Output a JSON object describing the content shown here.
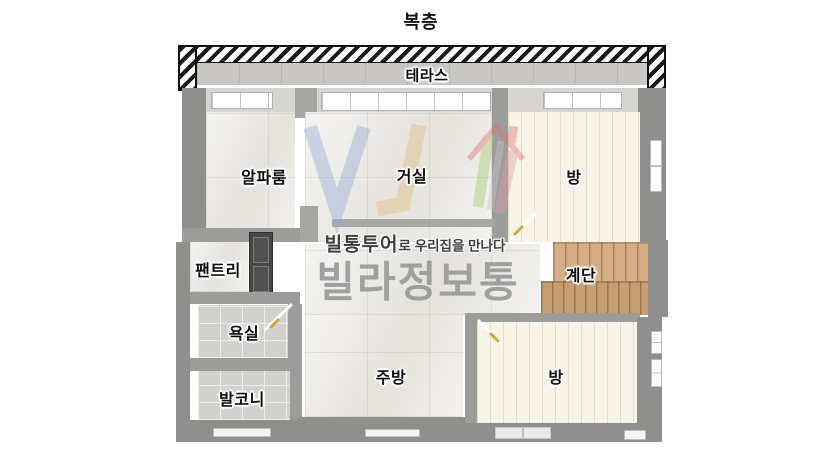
{
  "title": "복층",
  "rooms": {
    "terrace": {
      "label": "테라스"
    },
    "alpha": {
      "label": "알파룸"
    },
    "living": {
      "label": "거실"
    },
    "bedroom_top": {
      "label": "방"
    },
    "pantry": {
      "label": "팬트리"
    },
    "stairs": {
      "label": "계단"
    },
    "bath": {
      "label": "욕실"
    },
    "kitchen": {
      "label": "주방"
    },
    "balcony": {
      "label": "발코니"
    },
    "bedroom_bottom": {
      "label": "방"
    }
  },
  "watermark": {
    "brand_bold": "빌통투어",
    "tagline_rest": "로 우리집을 만나다",
    "brand_large": "빌라정보통"
  },
  "colors": {
    "wall_gray": "#9c9c9a",
    "marble_floor": "#eae8e3",
    "plank_floor": "#f8f3e7",
    "tile_floor": "#d2d1ce",
    "terrace_floor": "#c8c7c3",
    "stair_wood_upper": "#d4ae84",
    "stair_wood_lower": "#c59e73",
    "hatch_black": "#1a1a1a",
    "watermark_gray": "#9a9a9a",
    "tagline_dark": "#3e3e3e",
    "door_handle_gold": "#d8a62a",
    "logo_blue": "#93abd4",
    "logo_tan": "#e0be7d",
    "logo_green": "#a6c96f",
    "logo_pink": "#e39aac",
    "logo_red": "#e0716f"
  }
}
